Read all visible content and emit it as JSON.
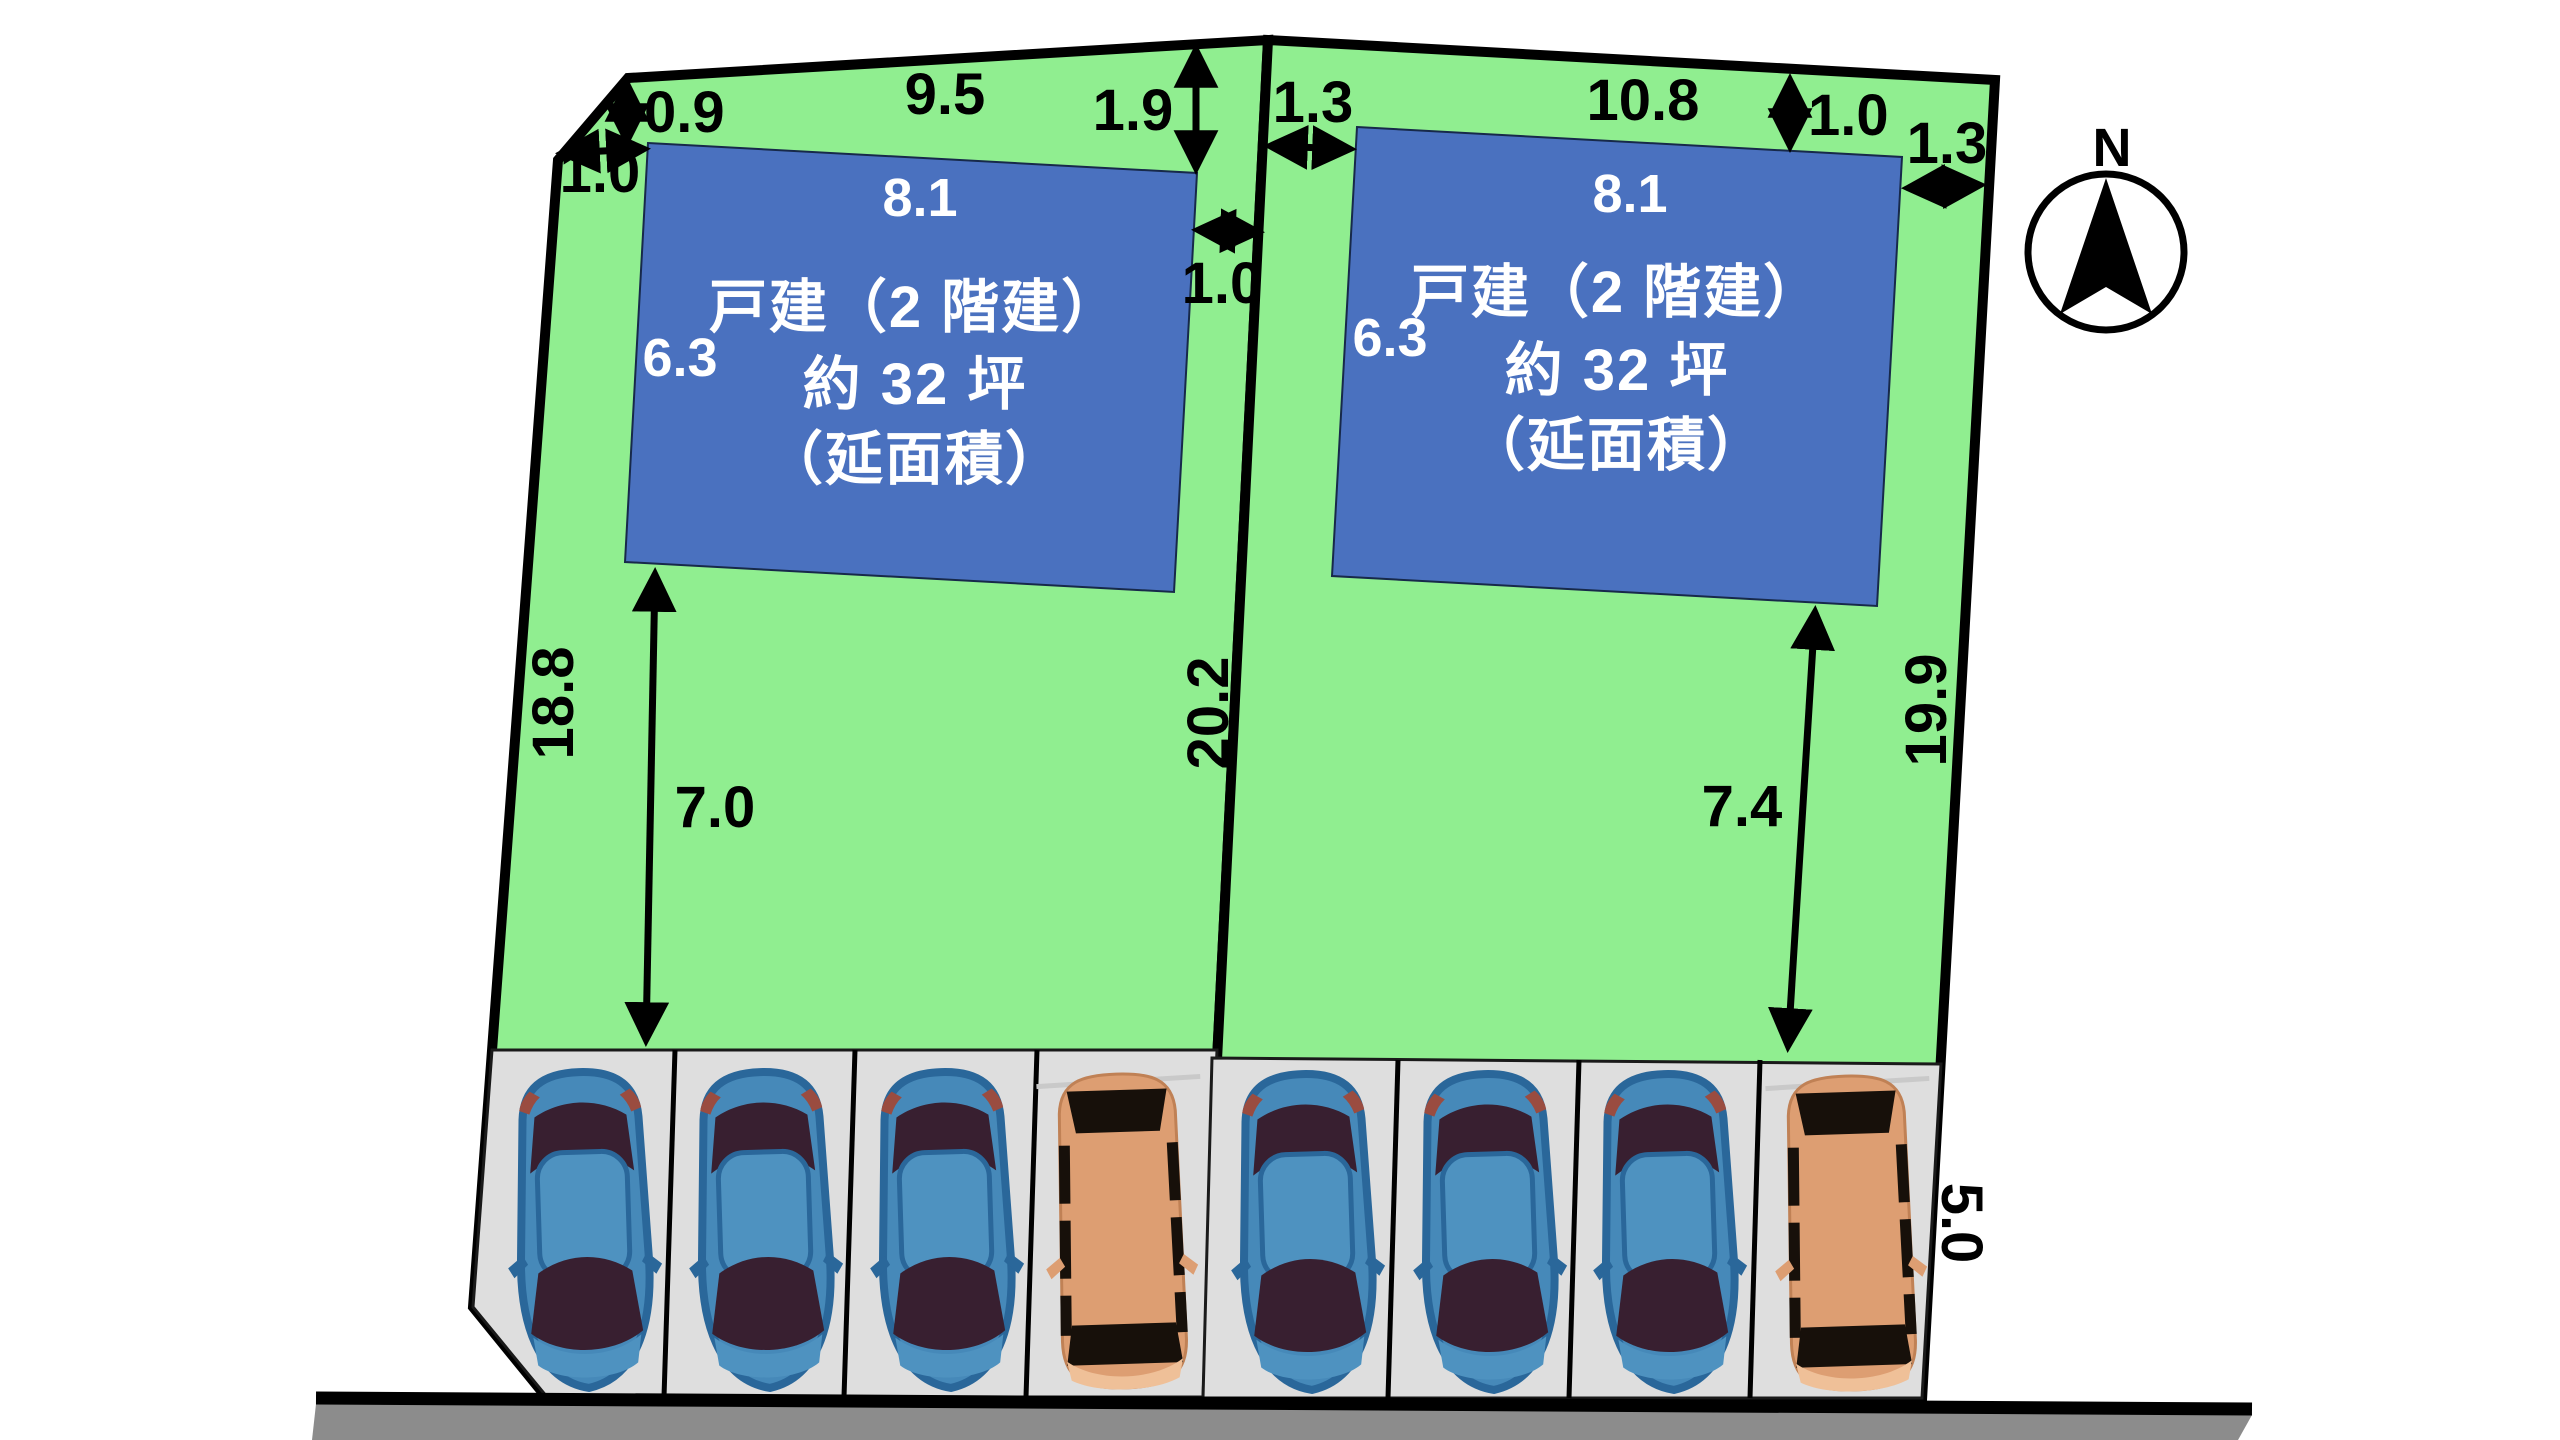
{
  "compass": {
    "label": "N"
  },
  "plot_left": {
    "building_text": [
      "戸建（2 階建）",
      "約 32 坪",
      "（延面積）"
    ],
    "building_width": "8.1",
    "building_depth": "6.3",
    "dim_chamfer": "1.0",
    "dim_front_setback": "0.9",
    "dim_top_edge": "9.5",
    "dim_right_setback": "1.9",
    "dim_side_gap": "1.0",
    "dim_left_edge": "18.8",
    "dim_yard": "7.0",
    "dim_right_edge": "20.2"
  },
  "plot_right": {
    "building_text": [
      "戸建（2 階建）",
      "約 32 坪",
      "（延面積）"
    ],
    "building_width": "8.1",
    "building_depth": "6.3",
    "dim_left_gap": "1.3",
    "dim_top_edge": "10.8",
    "dim_front_setback": "1.0",
    "dim_right_gap": "1.3",
    "dim_yard": "7.4",
    "dim_right_edge": "19.9",
    "dim_road_frontage": "5.0"
  },
  "colors": {
    "lot_green": "#90EE90",
    "building_blue": "#4A71BF",
    "parking_gray": "#DEDEDE",
    "road_gray": "#8C8C8C",
    "car_blue": "#4689B9",
    "van_tan": "#DD9E72"
  }
}
